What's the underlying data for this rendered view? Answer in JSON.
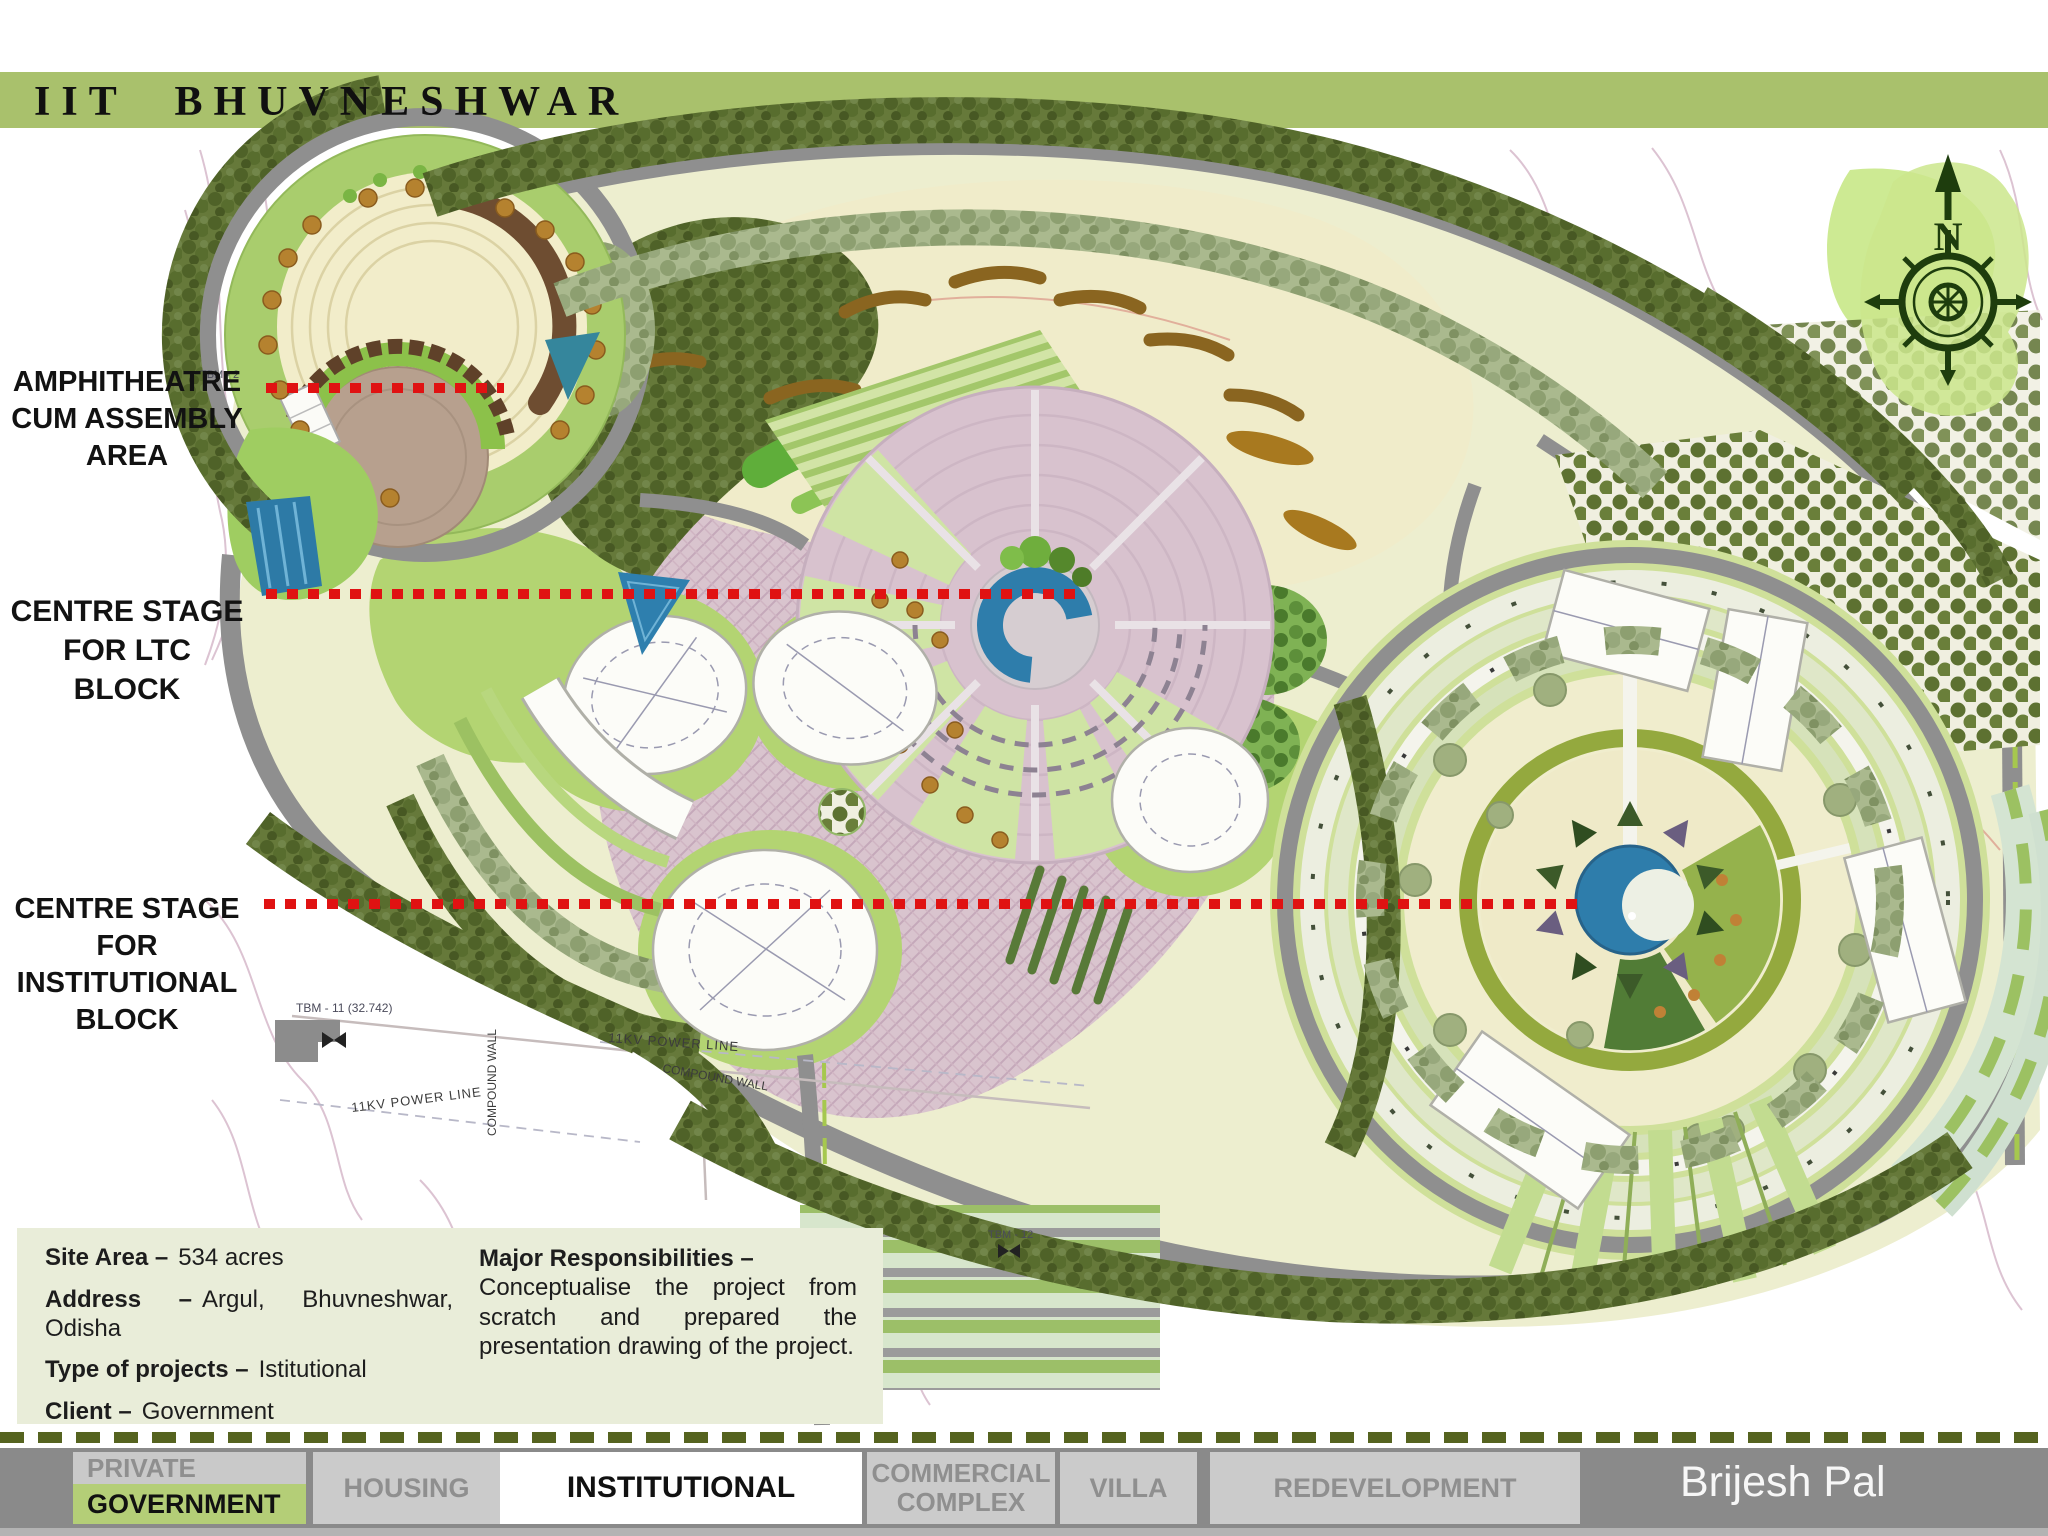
{
  "header": {
    "title": "IIT BHUVNESHWAR",
    "bar_color": "#a9c16c"
  },
  "callouts": {
    "amphitheatre": "AMPHITHEATRE\nCUM ASSEMBLY\nAREA",
    "ltc": "CENTRE STAGE\nFOR LTC BLOCK",
    "institutional": "CENTRE STAGE\nFOR\nINSTITUTIONAL\nBLOCK"
  },
  "info_panel": {
    "rows": [
      {
        "label": "Site Area –",
        "value": "534 acres"
      },
      {
        "label": "Address –",
        "value": "Argul, Bhuvneshwar, Odisha"
      },
      {
        "label": "Type of projects –",
        "value": "Istitutional"
      },
      {
        "label": "Client –",
        "value": "Government"
      }
    ],
    "responsibilities_title": "Major Responsibilities –",
    "responsibilities_body": "Conceptualise the project from scratch and prepared the presentation drawing of the project."
  },
  "tabs": {
    "tab1_top": "PRIVATE",
    "tab1_bottom": "GOVERNMENT",
    "tab2": "HOUSING",
    "tab3": "INSTITUTIONAL",
    "tab4_line1": "COMMERCIAL",
    "tab4_line2": "COMPLEX",
    "tab5": "VILLA",
    "tab6": "REDEVELOPMENT",
    "active_tab": "INSTITUTIONAL"
  },
  "author": "Brijesh Pal",
  "map": {
    "compass_label": "N",
    "annotations": {
      "tbm2": "TBM - 2",
      "tbm11": "TBM - 11 (32.742)",
      "tbm12": "TBM - 12",
      "power_line_1": "11KV POWER LINE",
      "power_line_2": "11KV POWER LINE",
      "compound_wall_1": "COMPOUND WALL",
      "compound_wall_2": "COMPOUND WALL"
    },
    "accent_red": "#e01212",
    "water_blue": "#2e7dab",
    "road_gray": "#8f8f8f"
  }
}
